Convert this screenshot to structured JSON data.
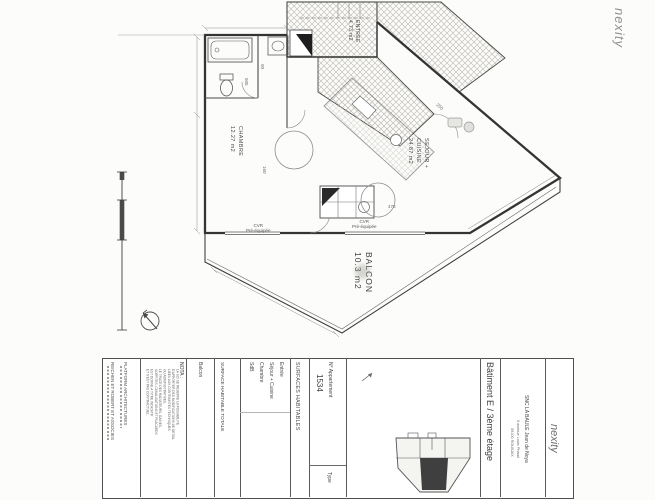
{
  "branding": {
    "logo_top": "nexity",
    "logo_title_block": "nexity"
  },
  "plan": {
    "rooms": {
      "entree": {
        "name": "ENTREE",
        "area": "4.73 m2"
      },
      "chambre": {
        "name": "CHAMBRE",
        "area": "12.27 m2"
      },
      "sejour": {
        "line1": "SEJOUR +",
        "line2": "CUISINE",
        "area": "24.87 m2"
      },
      "balcon": {
        "name": "BALCON",
        "area": "10.3 m2"
      }
    },
    "annotations": {
      "cvr_left": {
        "line1": "CVR",
        "line2": "Pré-équipée"
      },
      "cvr_right": {
        "line1": "CVR",
        "line2": "Pré-équipée"
      }
    },
    "dims": {
      "d1": "250",
      "d2": "478",
      "d3": "160",
      "d4": "90",
      "d5": "505"
    }
  },
  "title_block": {
    "architects": {
      "firm1": "PLATFORM ARCHITECTURES",
      "firm2": "REICHEN ET ROBERT ET ASSOCIES"
    },
    "nota": {
      "title": "NOTA :",
      "lines": [
        "LA SCI SE RESERVE LA POSSIBILITE",
        "D'APPORTER DES MODIFICATIONS DE DETAIL",
        "LIEES AUX CONTRAINTES TECHNIQUES",
        "OU ADMINISTRATIVES.",
        "LE TRACE DES RADIATEURS, GAINES,",
        "SOFFITES, CANALISATIONS ET PLACARDS",
        "EST DONNE A TITRE INDICATIF",
        "ET N'EST PAS CONTRACTUEL."
      ]
    },
    "surfaces": {
      "header": "SURFACES HABITABLES",
      "rows": [
        "Entrée",
        "Séjour + Cuisine",
        "Chambre",
        "SdB"
      ],
      "total_label": "SURFACE HABITABLE TOTALE",
      "balcon_label": "Balcon"
    },
    "apartment": {
      "number_label": "N° Appartement",
      "number": "1534",
      "type_label": "Type"
    },
    "location": {
      "building": "Bâtiment E / 3ème étage",
      "company": "SNC LA BAULE Jean de Noya",
      "address": "5 avenue Louis Phaud",
      "city": "59100 ROUBAIX"
    }
  }
}
